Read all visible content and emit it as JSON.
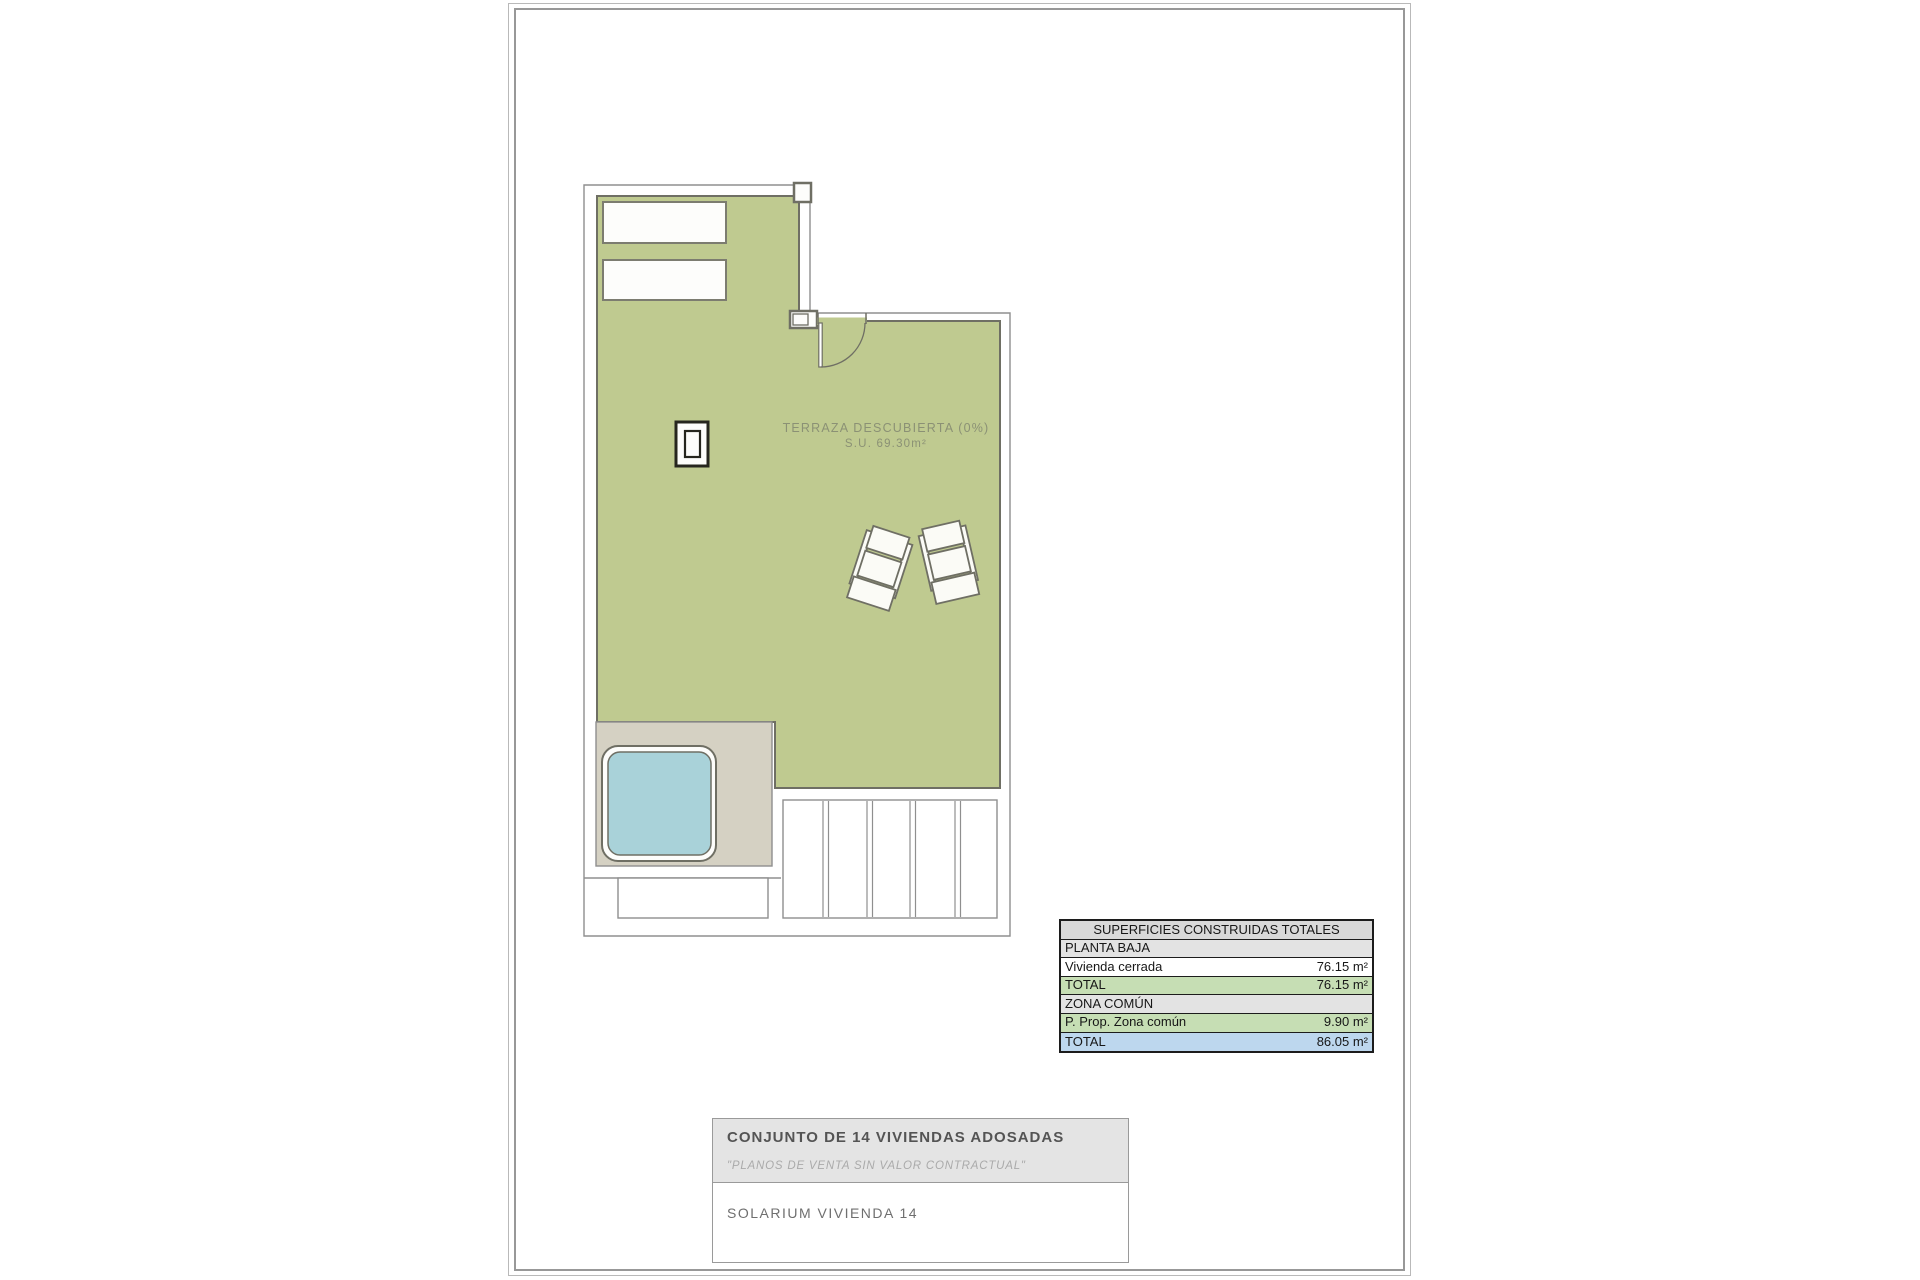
{
  "plan": {
    "area_label_line1": "TERRAZA DESCUBIERTA (0%)",
    "area_label_line2": "S.U. 69.30m²"
  },
  "surfaces_table": {
    "title": "SUPERFICIES CONSTRUIDAS TOTALES",
    "rows": [
      {
        "label": "PLANTA BAJA",
        "value": ""
      },
      {
        "label": "Vivienda cerrada",
        "value": "76.15 m²"
      },
      {
        "label": "TOTAL",
        "value": "76.15 m²"
      },
      {
        "label": "ZONA COMÚN",
        "value": ""
      },
      {
        "label": "P. Prop. Zona común",
        "value": "9.90 m²"
      },
      {
        "label": "TOTAL",
        "value": "86.05 m²"
      }
    ]
  },
  "title_block": {
    "project_title": "CONJUNTO DE 14 VIVIENDAS ADOSADAS",
    "disclaimer": "\"PLANOS DE VENTA SIN VALOR CONTRACTUAL\"",
    "drawing_name": "SOLARIUM VIVIENDA 14"
  },
  "colors": {
    "terrace_green": "#bfca90",
    "wall_stroke": "#6f6f64",
    "lot_line": "#8f8f8f",
    "beige_deck": "#d5d1c3",
    "pool_blue": "#a9d2d9",
    "fixture_stroke": "#26261e",
    "label_text": "#8b9175",
    "table_green": "#c6deb4",
    "table_blue": "#bdd7ee",
    "table_gray": "#d9d9d9"
  }
}
